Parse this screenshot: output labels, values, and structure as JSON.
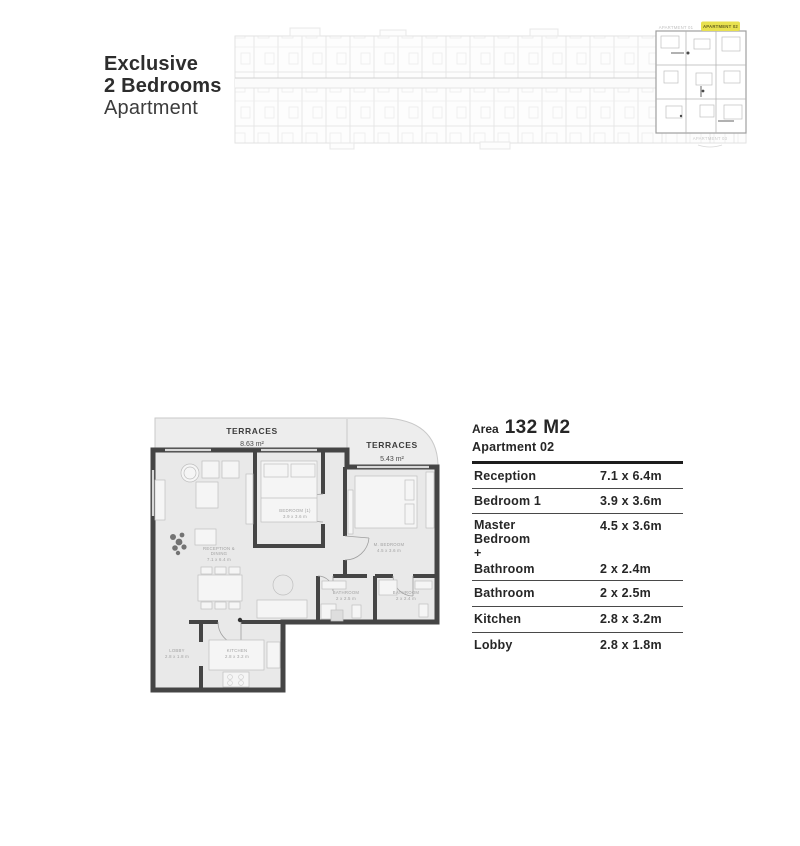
{
  "header": {
    "title_line1": "Exclusive",
    "title_line2": "2 Bedrooms",
    "title_line3": "Apartment"
  },
  "masterplan": {
    "label_left": "APARTMENT 01",
    "label_highlight": "APARTMENT 02",
    "label_bottom": "APARTMENT 03"
  },
  "floorplan": {
    "terrace_left": {
      "name": "TERRACES",
      "area": "8.63 m²"
    },
    "terrace_right": {
      "name": "TERRACES",
      "area": "5.43 m²"
    },
    "rooms": {
      "bedroom1": {
        "name": "BEDROOM (1)",
        "dims": "3.9 x 3.6 m"
      },
      "master": {
        "name": "M. BEDROOM",
        "dims": "4.5 x 3.6 m"
      },
      "reception": {
        "name1": "RECEPTION &",
        "name2": "DINING",
        "dims": "7.1 x 6.4 m"
      },
      "bath1": {
        "name": "BATHROOM",
        "dims": "2 x 2.5 m"
      },
      "bath2": {
        "name": "BATHROOM",
        "dims": "2 x 2.4 m"
      },
      "kitchen": {
        "name": "KITCHEN",
        "dims": "2.8 x 3.2 m"
      },
      "lobby": {
        "name": "LOBBY",
        "dims": "2.8 x 1.8 m"
      }
    }
  },
  "details": {
    "area_label": "Area",
    "area_value": "132 M2",
    "apartment": "Apartment 02",
    "rows": [
      {
        "label": "Reception",
        "value": "7.1 x 6.4m"
      },
      {
        "label": "Bedroom 1",
        "value": "3.9 x 3.6m"
      },
      {
        "label": "Master\nBedroom\n+",
        "value": "4.5 x 3.6m",
        "label2": "Bathroom",
        "value2": "2 x 2.4m"
      },
      {
        "label": "Bathroom",
        "value": "2 x 2.5m"
      },
      {
        "label": "Kitchen",
        "value": "2.8 x 3.2m"
      },
      {
        "label": "Lobby",
        "value": "2.8 x 1.8m"
      }
    ]
  },
  "colors": {
    "wall": "#454545",
    "floor": "#e9e9e9",
    "terrace": "#ededed",
    "highlight": "#e8e14f"
  }
}
